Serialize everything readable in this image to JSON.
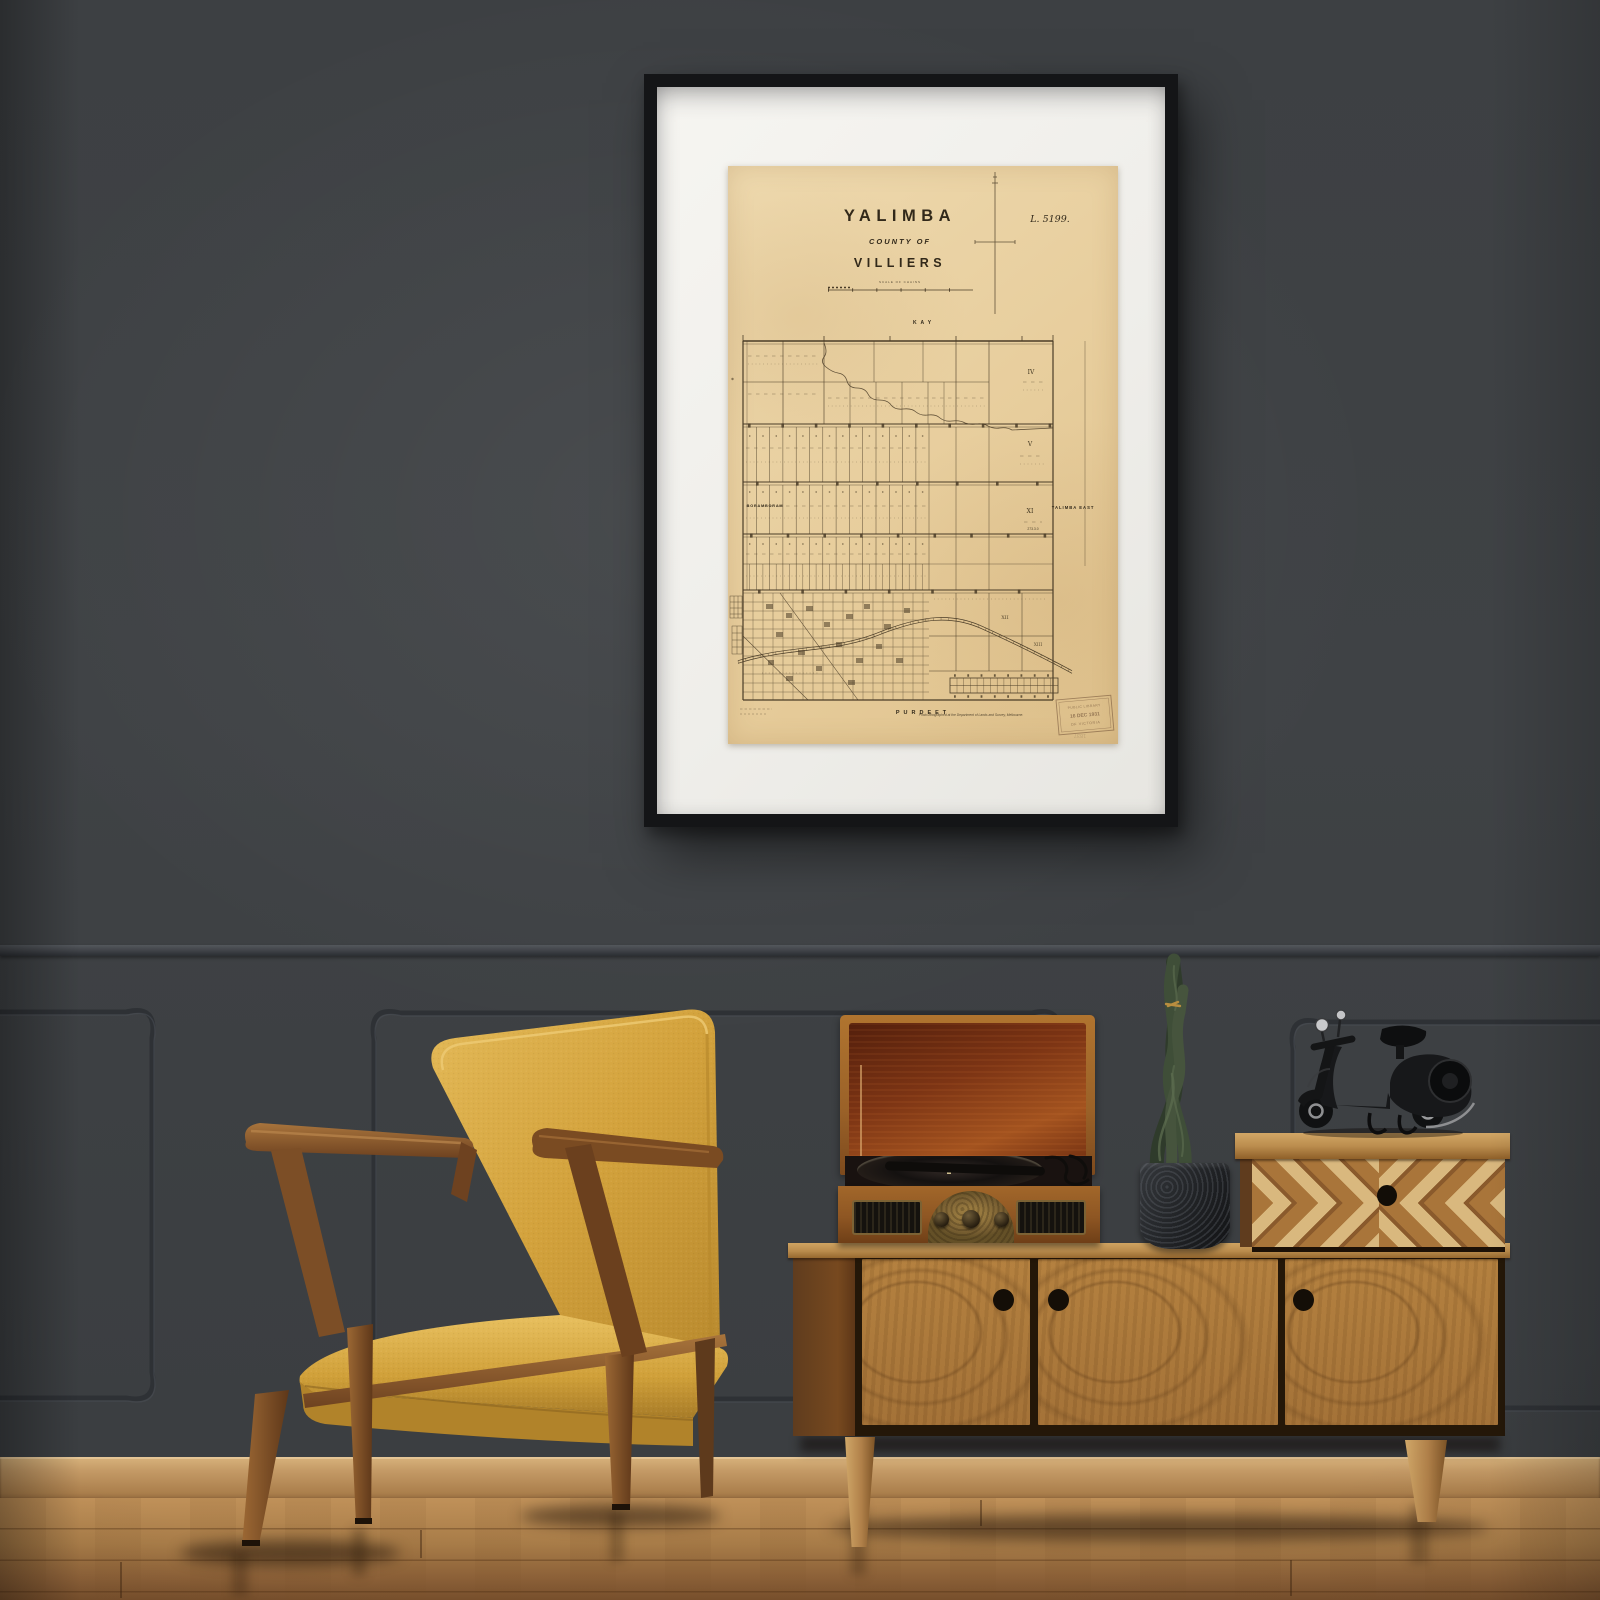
{
  "poster": {
    "plate_number": "L. 5199.",
    "title_line1": "YALIMBA",
    "title_line2": "COUNTY OF",
    "title_line3": "VILLIERS",
    "scale_caption": "SCALE OF CHAINS",
    "neighbor_labels": {
      "north": "KAY",
      "west": "BORAMBORAM",
      "east": "YALIMBA EAST",
      "south": "PURDEET"
    },
    "section_numerals": {
      "s4": "IV",
      "s5": "V",
      "s11": "XI",
      "s12": "XII",
      "s13": "XIII"
    },
    "parcel_note": "273.3.0",
    "stamp": {
      "line1": "PUBLIC LIBRARY",
      "line2": "16 DEC 1931",
      "line3": "OF VICTORIA"
    },
    "imprint": "Photo-lithographed at the Department of Lands and Survey, Melbourne.",
    "verso_mark": "1837"
  },
  "palette": {
    "wall": "#3e4144",
    "frame": "#141517",
    "mat": "#f3f2ee",
    "paper": "#e8d2a2",
    "map_ink": "#4a3c27",
    "floor": "#a87c48",
    "baseboard": "#c49a66",
    "chair_fabric": "#d3a23c",
    "chair_wood": "#8a5a2c",
    "oak": "#b07c3f",
    "inlay_light": "#d9b87e",
    "plant_green": "#3f4e38",
    "pot_black": "#26282b",
    "scooter_black": "#17181a",
    "lid_interior": "#7c3a16",
    "brass": "#8d713c"
  }
}
